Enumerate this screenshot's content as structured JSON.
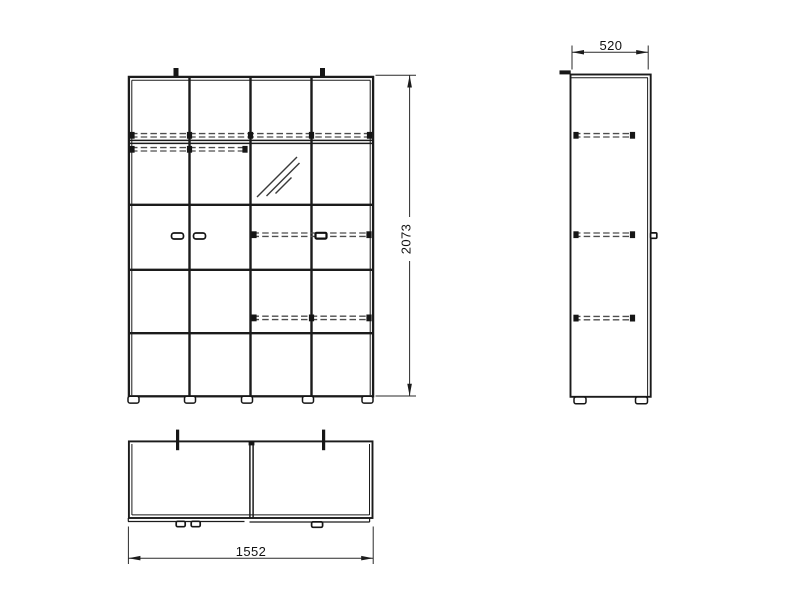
{
  "page": {
    "background": "#ffffff"
  },
  "drawing": {
    "kind": "furniture-orthographic-technical-drawing",
    "line_color": "#1b1b1b",
    "dash_color": "#4d4d4d",
    "dimensions": {
      "height": "2073",
      "depth": "520",
      "width": "1552"
    }
  }
}
